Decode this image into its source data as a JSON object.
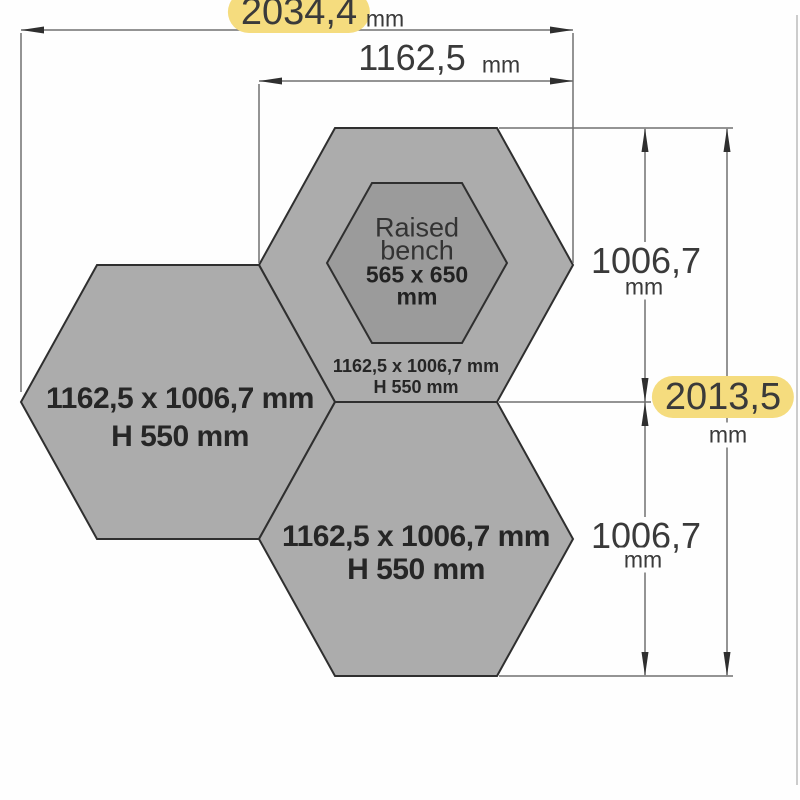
{
  "dimensions": {
    "total_width": {
      "value": "2034,4",
      "unit": "mm",
      "highlighted": true
    },
    "top_hex_width": {
      "value": "1162,5",
      "unit": "mm",
      "highlighted": false
    },
    "upper_height": {
      "value": "1006,7",
      "unit": "mm",
      "highlighted": false
    },
    "total_height": {
      "value": "2013,5",
      "unit": "mm",
      "highlighted": true
    },
    "lower_height": {
      "value": "1006,7",
      "unit": "mm",
      "highlighted": false
    }
  },
  "hexagons": {
    "left": {
      "size": "1162,5 x 1006,7 mm",
      "height": "H 550 mm"
    },
    "top": {
      "size": "1162,5 x 1006,7 mm",
      "height": "H 550 mm"
    },
    "bottom": {
      "size": "1162,5 x 1006,7 mm",
      "height": "H 550 mm"
    },
    "raised_bench": {
      "name_line1": "Raised",
      "name_line2": "bench",
      "size": "565 x 650",
      "unit": "mm"
    }
  },
  "colors": {
    "hexagon_fill": "#acacac",
    "bench_fill": "#9b9b9b",
    "outline": "#2f2f2f",
    "dimension_line": "#707070",
    "highlight": "#f5dc7e",
    "text": "#3a3a3a"
  }
}
